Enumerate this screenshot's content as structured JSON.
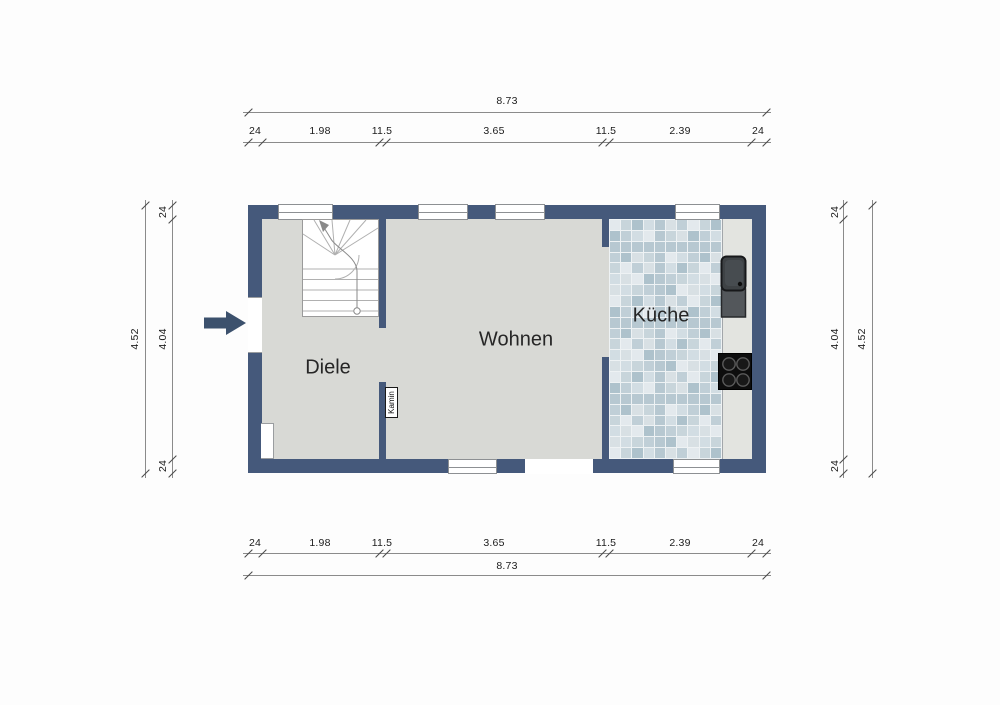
{
  "floor_plan": {
    "rooms": [
      {
        "name": "Diele"
      },
      {
        "name": "Wohnen"
      },
      {
        "name": "Küche"
      }
    ],
    "annotations": {
      "kamin": "Kamin"
    },
    "dimensions": {
      "top": {
        "total": "8.73",
        "segments": [
          "24",
          "1.98",
          "11.5",
          "3.65",
          "11.5",
          "2.39",
          "24"
        ]
      },
      "bottom": {
        "total": "8.73",
        "segments": [
          "24",
          "1.98",
          "11.5",
          "3.65",
          "11.5",
          "2.39",
          "24"
        ]
      },
      "left": {
        "total": "4.52",
        "segments": [
          "24",
          "4.04",
          "24"
        ]
      },
      "right": {
        "total": "4.52",
        "segments": [
          "24",
          "4.04",
          "24"
        ]
      }
    },
    "colors": {
      "wall": "#45597b",
      "floor": "#d8d9d5",
      "counter": "#e3e4e0",
      "tile_grout": "#eef2f4",
      "tile_palette": [
        "#e3e9ed",
        "#d2dde3",
        "#c0cfd7",
        "#aec2cc",
        "#d8e0e4",
        "#c8d5db",
        "#b7c8d1"
      ],
      "entrance_arrow": "#3c516d"
    },
    "icons": {
      "entrance_arrow": "entrance-arrow-icon",
      "staircase": "staircase",
      "sink": "kitchen-sink",
      "stove": "stove-cooktop"
    }
  }
}
